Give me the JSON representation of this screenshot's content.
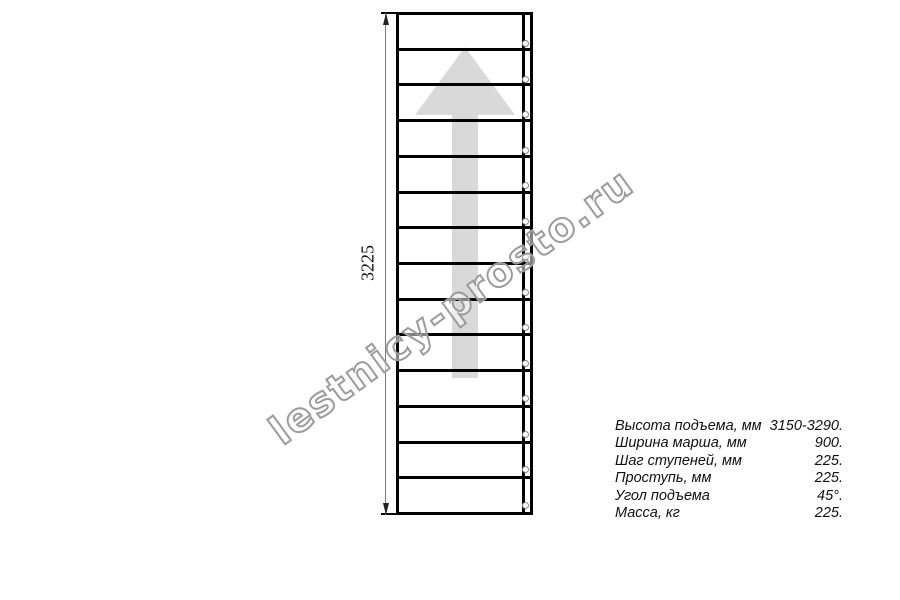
{
  "watermark": {
    "text": "lestnicy-prosto.ru",
    "stroke_color": "#9c9c9c"
  },
  "drawing": {
    "dimension_label": "3225",
    "tread_count": 14,
    "arrow_icon": "up-arrow",
    "arrow_color": "#d9d9d9",
    "outline_color": "#000000",
    "hole_color": "#878787"
  },
  "specs": {
    "rows": [
      {
        "label": "Высота подъема, мм",
        "value": "3150-3290."
      },
      {
        "label": "Ширина марша, мм",
        "value": "900."
      },
      {
        "label": "Шаг ступеней, мм",
        "value": "225."
      },
      {
        "label": "Проступь, мм",
        "value": "225."
      },
      {
        "label": "Угол подъема",
        "value": "45°."
      },
      {
        "label": "Масса, кг",
        "value": "225."
      }
    ]
  }
}
